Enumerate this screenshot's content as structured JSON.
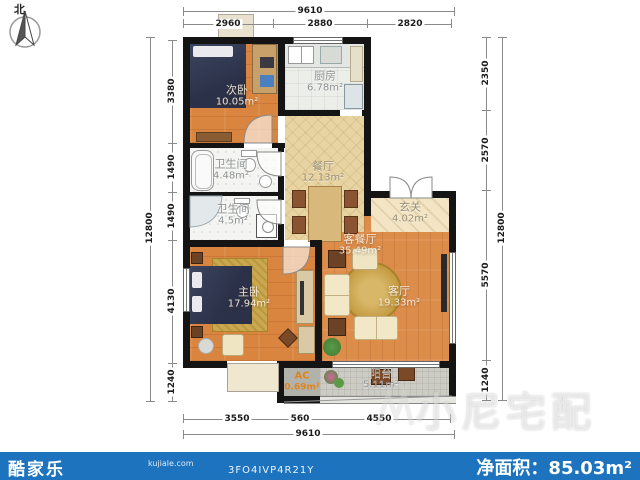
{
  "compass": {
    "label": "北"
  },
  "watermark": {
    "text": "小尼宅配"
  },
  "footer": {
    "brand": "酷家乐",
    "brand_domain": "kujiale.com",
    "plan_code": "3FO4IVP4R21Y",
    "area_label": "净面积：",
    "area_value": "85.03m²",
    "bar_color": "#1e73bf"
  },
  "rooms": [
    {
      "id": "ciwo",
      "name": "次卧",
      "area": "10.05m²"
    },
    {
      "id": "chufang",
      "name": "厨房",
      "area": "6.78m²"
    },
    {
      "id": "weishengjian1",
      "name": "卫生间",
      "area": "4.48m²"
    },
    {
      "id": "weishengjian2",
      "name": "卫生间",
      "area": "4.5m²"
    },
    {
      "id": "canting",
      "name": "餐厅",
      "area": "12.13m²"
    },
    {
      "id": "xuanguan",
      "name": "玄关",
      "area": "4.02m²"
    },
    {
      "id": "kecanting",
      "name": "客餐厅",
      "area": "35.49m²"
    },
    {
      "id": "keting",
      "name": "客厅",
      "area": "19.33m²"
    },
    {
      "id": "zhuwo",
      "name": "主卧",
      "area": "17.94m²"
    },
    {
      "id": "ac",
      "name": "AC",
      "area": "0.69m²"
    },
    {
      "id": "yangtai",
      "name": "阳台",
      "area": "5.11m²"
    }
  ],
  "dims": {
    "top_total": "9610",
    "top_segments": [
      "2960",
      "2880",
      "2820"
    ],
    "left_total": "12800",
    "left_segments": [
      "3380",
      "1490",
      "1490",
      "4130",
      "1240"
    ],
    "right_total": "12800",
    "right_segments": [
      "2350",
      "2570",
      "5570",
      "1240"
    ],
    "bottom_segments": [
      "3550",
      "560",
      "4550"
    ],
    "bottom_total": "9610"
  },
  "palette": {
    "wall": "#141414",
    "wood_floor": "#d9853f",
    "dining_floor": "#e7d4a2",
    "entry_floor": "#f3e5c4",
    "kitchen_floor": "#eceeea",
    "bath_floor": "#f4f4f2",
    "balcony_floor": "#ccccc5",
    "footer_blue": "#1e73bf",
    "ac_text": "#e0841c"
  }
}
